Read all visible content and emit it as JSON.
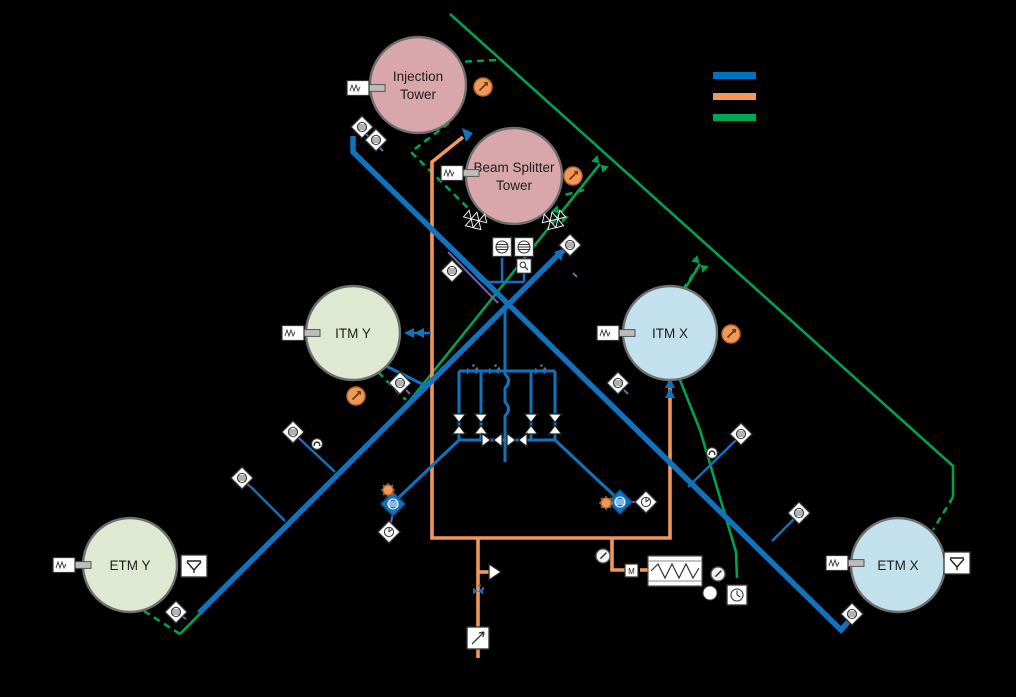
{
  "diagram": {
    "background": "#000000",
    "legend": {
      "items": [
        {
          "id": "blue-line-swatch",
          "color": "#0072BD"
        },
        {
          "id": "orange-line-swatch",
          "color": "#F2975A"
        },
        {
          "id": "green-line-swatch",
          "color": "#00A651"
        }
      ]
    },
    "towers": {
      "injection": {
        "line1": "Injection",
        "line2": "Tower",
        "fill": "#D9A7AB"
      },
      "beam_splitter": {
        "line1": "Beam Splitter",
        "line2": "Tower",
        "fill": "#D9A7AB"
      },
      "itm_y": {
        "label": "ITM Y",
        "fill": "#DFE8D0"
      },
      "itm_x": {
        "label": "ITM X",
        "fill": "#C3E0ED"
      },
      "etm_y": {
        "label": "ETM Y",
        "fill": "#DFE8D0"
      },
      "etm_x": {
        "label": "ETM X",
        "fill": "#C3E0ED"
      }
    },
    "labels": {
      "motor_valve": "M"
    },
    "colors": {
      "blue": "#1173BD",
      "orange": "#F0975B",
      "green": "#00A24D",
      "purple": "#7B5EA7",
      "pink": "#D9A7AB",
      "sage": "#DFE8D0",
      "light_blue": "#C3E0ED"
    },
    "icons": {
      "gauge": "dial-with-arrow",
      "ion_pump": "diamond-hatched-circle",
      "turbo_pump": "square-hatched-circle",
      "valve": "bowtie",
      "vent_valve": "v-symbol",
      "rga": "magnifier",
      "filter": "zigzag-box",
      "check_valve": "triangle-right",
      "pump_cart": "square-diagonal-arrow",
      "timer": "circle-sector",
      "clock": "circle-clock"
    }
  }
}
